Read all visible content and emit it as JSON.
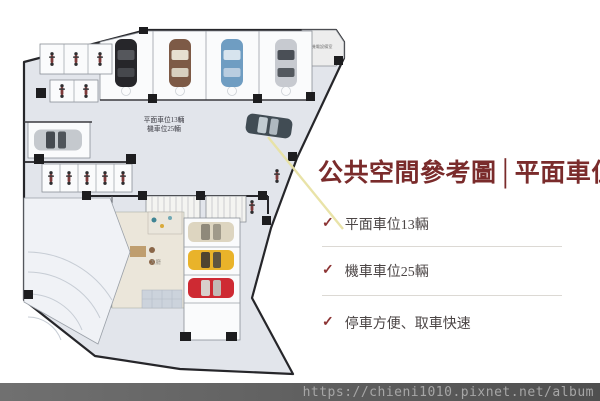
{
  "floor_plan": {
    "label_line1": "平面車位13輛",
    "label_line2": "機車位25輛",
    "room_label": "機電設備室",
    "lobby_label": "大廳",
    "colors": {
      "floor": "#e2e5eb",
      "wall": "#26262a",
      "stall": "#fafbfc",
      "pointer_line": "#e8e2a4",
      "car_black": "#26262a",
      "car_brown": "#7d5a46",
      "car_blue": "#6f9dc2",
      "car_silver": "#c7cad0",
      "car_cream": "#ddd5c0",
      "car_yellow": "#e9b32a",
      "car_red": "#ce2a33"
    }
  },
  "panel": {
    "title": "公共空間參考圖│平面車位",
    "title_color": "#7a2b2b",
    "check_glyph": "✓",
    "bullets": [
      {
        "text": "平面車位13輛"
      },
      {
        "text": "機車車位25輛"
      },
      {
        "text": "停車方便、取車快速"
      }
    ]
  },
  "footer": {
    "url": "https://chieni1010.pixnet.net/album",
    "background": "#5c5c5c",
    "text_color": "#a6a6a6"
  }
}
